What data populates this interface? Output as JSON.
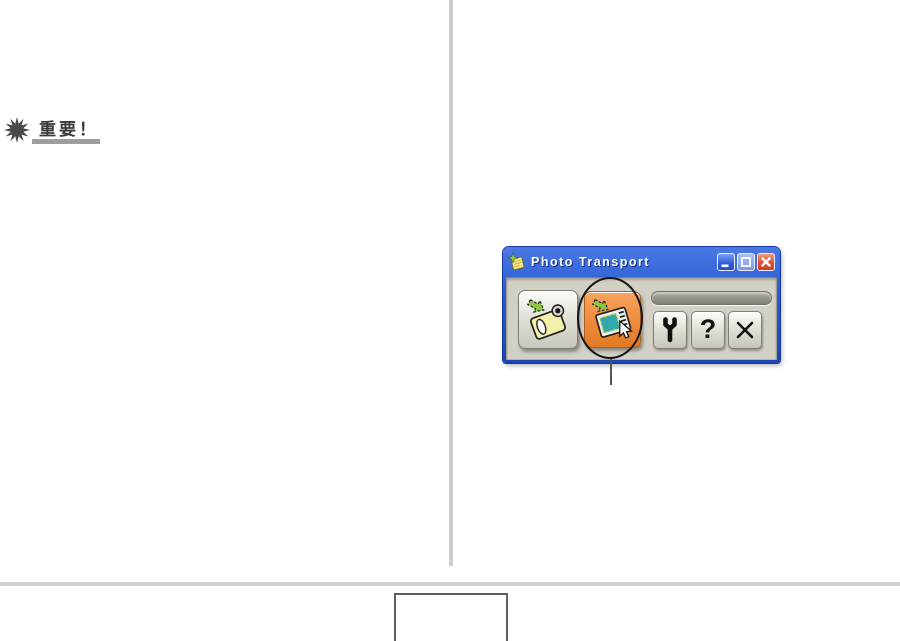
{
  "page": {
    "important": {
      "label": "重要！"
    },
    "footer": {
      "page_box_text": ""
    }
  },
  "window": {
    "title": "Photo Transport",
    "controls": {
      "minimize": "minimize",
      "maximize": "maximize",
      "close": "close"
    },
    "toolbar": {
      "help_glyph": "?"
    }
  },
  "annotation": {
    "type": "circle-with-callout",
    "target": "photo-transport-button"
  },
  "colors": {
    "titlebar_blue": "#2A5CCF",
    "window_border_blue": "#16389E",
    "body_gray": "#D3D1C5",
    "highlight_orange": "#EE8A3C",
    "button_silver": "#DDDCD2",
    "divider_gray": "#CDCDCD",
    "icon_teal": "#31A8AC",
    "icon_yellow": "#F2EFA6",
    "icon_green": "#8DC63F"
  }
}
